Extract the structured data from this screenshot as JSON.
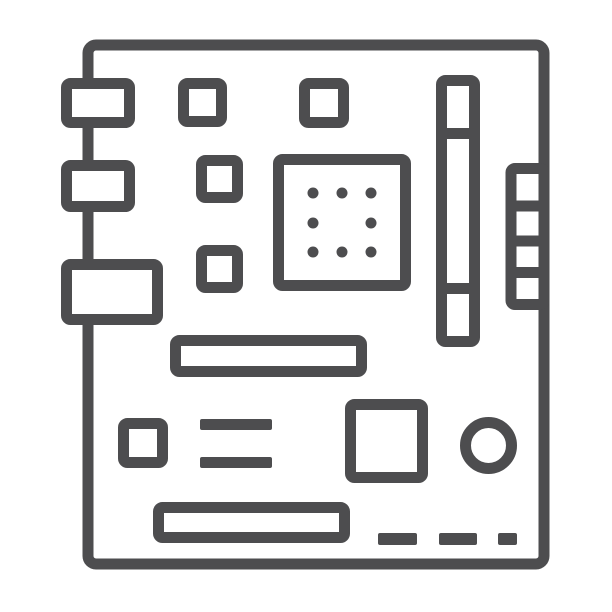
{
  "icon": {
    "name": "motherboard-icon",
    "style": "thin-line outline glyph",
    "subject": "computer motherboard with rear I/O ports, chips, CPU socket with pin dots, RAM slot, right-side pin header, expansion slots, jumper block, chipset square, CMOS battery circle and solder pads",
    "colors": {
      "stroke": "#4d4d4f",
      "fill": "#ffffff",
      "background": "#ffffff"
    },
    "stroke_width": 11,
    "canvas": {
      "width": 612,
      "height": 612
    },
    "components": [
      "board-outline",
      "rear-io-port-top",
      "rear-io-port-middle",
      "rear-io-port-bottom",
      "chip-square-1",
      "chip-square-2",
      "chip-square-3",
      "chip-square-4",
      "cpu-socket",
      "cpu-pin-grid (8 dots)",
      "ram-slot (3 sections)",
      "pin-header-ladder (4 cells)",
      "expansion-slot-upper",
      "expansion-slot-lower",
      "jumper-square",
      "jumper-pin-bars (2)",
      "chipset-square",
      "cmos-battery-circle",
      "solder-pads (3 dashes)"
    ]
  }
}
